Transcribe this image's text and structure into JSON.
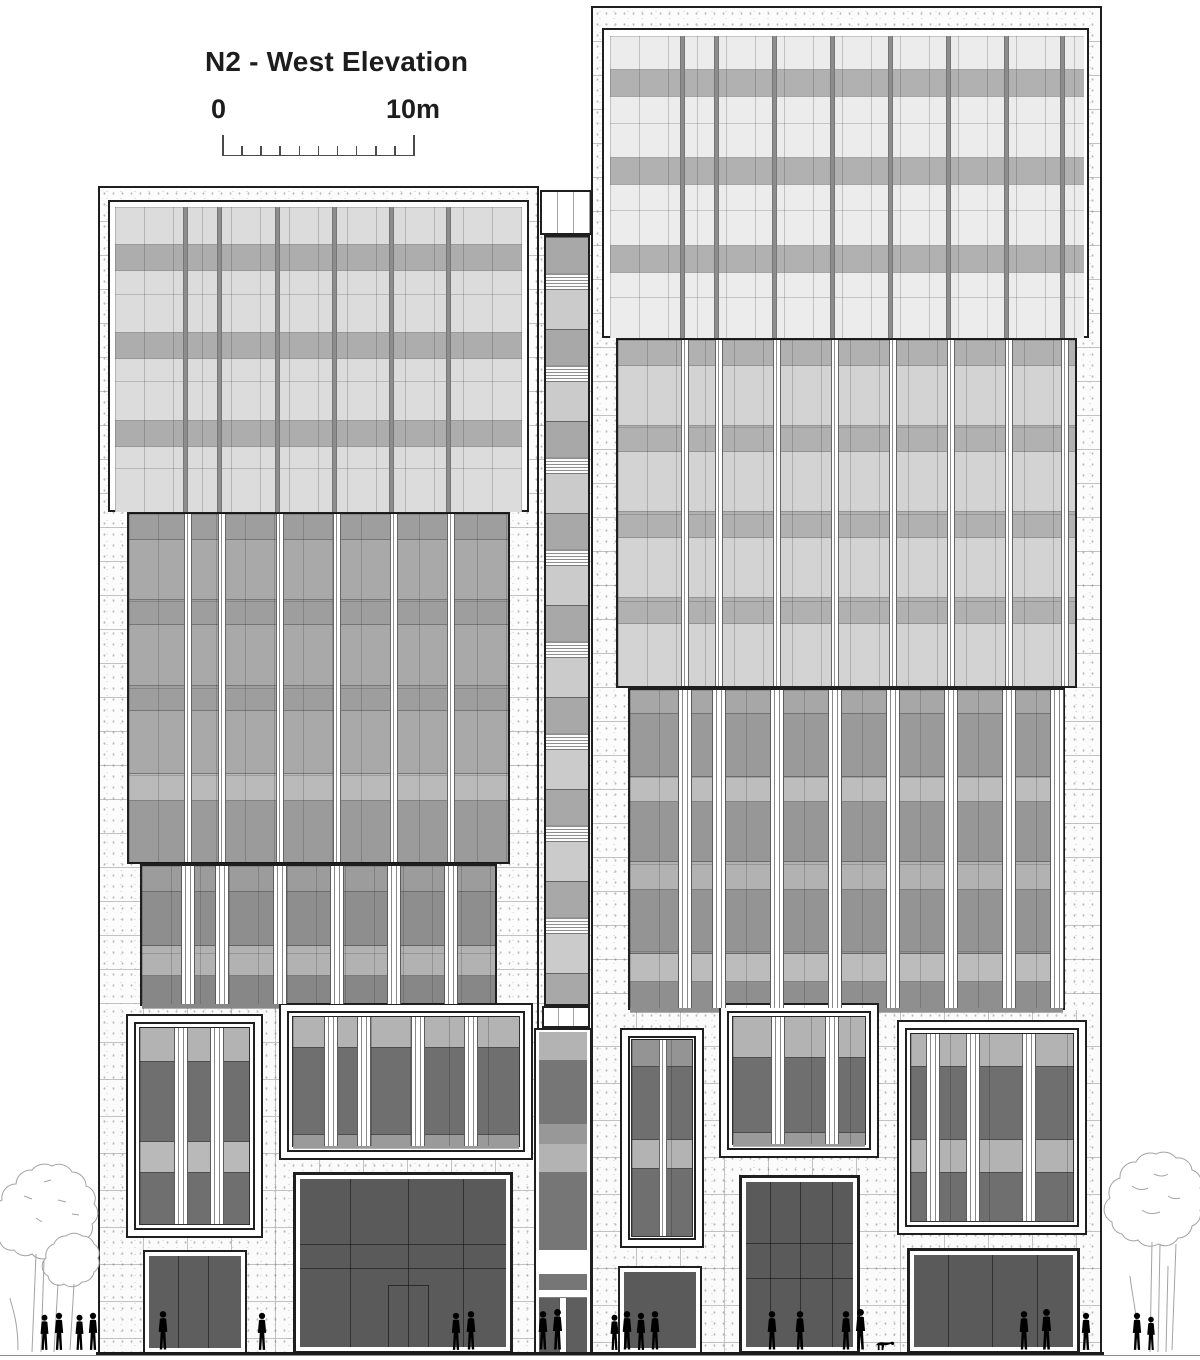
{
  "drawing": {
    "title": "N2 - West Elevation"
  },
  "scale_bar": {
    "start_label": "0",
    "end_label": "10m",
    "divisions": 10
  },
  "colors": {
    "outline": "#1f1f1f",
    "stoneJoint": "#c2c2c2",
    "glassTopLeft": "#dcdcdc",
    "glassTopRight": "#ececec",
    "glassMidLeft": "#a9a9a9",
    "glassMidRight": "#d3d3d3",
    "glassLowLeft": "#9c9c9c",
    "glassLowRight": "#a7a7a7",
    "spandrelLight": "#b1b1b1",
    "spandrelTopLeft": "#adadad",
    "spandrelMid": "#9e9e9e",
    "bandLight": "#b3b3b3",
    "glazingDark": "#6f6f6f",
    "entranceDark": "#5a5a5a",
    "doorDark": "#5e5e5e",
    "coreGray": "#a8a8a8",
    "coreLight": "#cbcbcb",
    "figureLine": "#787878",
    "treeLine": "#a3a3a3",
    "groundLine": "#1a1a1a",
    "textColor": "#1d1d1d"
  }
}
